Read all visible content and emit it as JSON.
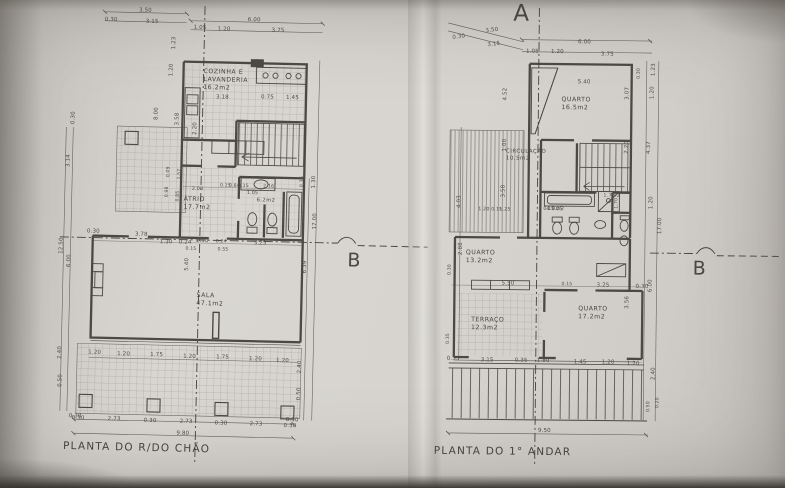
{
  "photo": {
    "paper_color": "#d7d4cf",
    "line_color": "#4c4944",
    "text_color": "#504d48"
  },
  "left_plan": {
    "title": "PLANTA DO R/DO CHÃO",
    "section_b": "B",
    "labels": [
      {
        "n": "room-label-cozinha",
        "c": "room",
        "t": "COZINHA E\nLAVANDERIA\n16.2m2",
        "x": 200,
        "y": 68
      },
      {
        "n": "room-label-atrio",
        "c": "room",
        "t": "ÁTRIO\n17.7m2",
        "x": 183,
        "y": 196
      },
      {
        "n": "room-label-is",
        "c": "room",
        "t": "6.2m2",
        "x": 256,
        "y": 196,
        "s": 5
      },
      {
        "n": "room-label-sala",
        "c": "room",
        "t": "SALA\n47.1m2",
        "x": 198,
        "y": 292
      },
      {
        "t": "3.50",
        "x": 134,
        "y": 9
      },
      {
        "t": "0.30",
        "x": 100,
        "y": 19
      },
      {
        "t": "3.15",
        "x": 141,
        "y": 20
      },
      {
        "t": "6.00",
        "x": 243,
        "y": 16
      },
      {
        "t": "1.05",
        "x": 189,
        "y": 25
      },
      {
        "t": "1.20",
        "x": 213,
        "y": 26
      },
      {
        "t": "3.75",
        "x": 267,
        "y": 26
      },
      {
        "t": "0.30",
        "x": 68,
        "y": 127,
        "r": -90
      },
      {
        "t": "3.14",
        "x": 64,
        "y": 170,
        "r": -90
      },
      {
        "t": "1.23",
        "x": 167,
        "y": 50,
        "r": -90
      },
      {
        "t": "1.20",
        "x": 165,
        "y": 77,
        "r": -90
      },
      {
        "t": "8.00",
        "x": 151,
        "y": 121,
        "r": -90
      },
      {
        "t": "3.58",
        "x": 172,
        "y": 126,
        "r": -90
      },
      {
        "t": "2.20",
        "x": 190,
        "y": 135,
        "r": -90
      },
      {
        "t": "3.18",
        "x": 213,
        "y": 94
      },
      {
        "t": "0.75",
        "x": 258,
        "y": 93
      },
      {
        "t": "1.45",
        "x": 283,
        "y": 93
      },
      {
        "t": "0.09",
        "x": 165,
        "y": 178,
        "r": -90,
        "s": 4.6
      },
      {
        "t": "1.57",
        "x": 176,
        "y": 180,
        "r": -90,
        "s": 4.6
      },
      {
        "t": "0.98",
        "x": 164,
        "y": 198,
        "r": -90,
        "s": 4.6
      },
      {
        "t": "0.85",
        "x": 175,
        "y": 202,
        "r": -90,
        "s": 4.6
      },
      {
        "t": "2.00",
        "x": 191,
        "y": 187,
        "s": 4.8
      },
      {
        "t": "0.15",
        "x": 219,
        "y": 183,
        "s": 4.6
      },
      {
        "t": "0.84",
        "x": 228,
        "y": 183,
        "s": 4.6
      },
      {
        "t": "0.15",
        "x": 237,
        "y": 183,
        "s": 4.6
      },
      {
        "t": "2.16",
        "x": 262,
        "y": 183,
        "s": 4.8
      },
      {
        "t": "1.05",
        "x": 246,
        "y": 190,
        "s": 4.8
      },
      {
        "t": "0.36",
        "x": 299,
        "y": 185,
        "r": -90,
        "s": 4.8
      },
      {
        "t": "1.30",
        "x": 310,
        "y": 186,
        "r": -90
      },
      {
        "t": "17.00",
        "x": 312,
        "y": 227,
        "r": -90
      },
      {
        "t": "12.50",
        "x": 59,
        "y": 257,
        "r": -90
      },
      {
        "t": "6.00",
        "x": 67,
        "y": 270,
        "r": -90
      },
      {
        "t": "2.40",
        "x": 60,
        "y": 362,
        "r": -90
      },
      {
        "t": "0.50",
        "x": 61,
        "y": 390,
        "r": -90
      },
      {
        "t": "0.30",
        "x": 73,
        "y": 416
      },
      {
        "t": "0.30",
        "x": 87,
        "y": 231
      },
      {
        "t": "3.78",
        "x": 135,
        "y": 233
      },
      {
        "t": "1.30",
        "x": 160,
        "y": 240
      },
      {
        "t": "0.24",
        "x": 179,
        "y": 240
      },
      {
        "t": "0.15",
        "x": 186,
        "y": 247,
        "s": 4.6
      },
      {
        "t": "1.90",
        "x": 196,
        "y": 238
      },
      {
        "t": "0.24",
        "x": 216,
        "y": 239,
        "s": 4.6
      },
      {
        "t": "0.55",
        "x": 218,
        "y": 247,
        "s": 4.6
      },
      {
        "t": "3.25",
        "x": 254,
        "y": 239
      },
      {
        "t": "5.40",
        "x": 185,
        "y": 271,
        "r": -90
      },
      {
        "t": "6.39",
        "x": 303,
        "y": 271,
        "r": -90
      },
      {
        "t": "2.40",
        "x": 300,
        "y": 371,
        "r": -90
      },
      {
        "t": "0.50",
        "x": 300,
        "y": 398,
        "r": -90
      },
      {
        "t": "0.30",
        "x": 290,
        "y": 415
      },
      {
        "t": "1.20",
        "x": 91,
        "y": 352
      },
      {
        "t": "1.20",
        "x": 120,
        "y": 353
      },
      {
        "t": "1.75",
        "x": 153,
        "y": 353
      },
      {
        "t": "1.20",
        "x": 186,
        "y": 354
      },
      {
        "t": "1.75",
        "x": 219,
        "y": 354
      },
      {
        "t": "1.20",
        "x": 252,
        "y": 355
      },
      {
        "t": "1.20",
        "x": 279,
        "y": 356
      },
      {
        "t": "0.30",
        "x": 76,
        "y": 418
      },
      {
        "t": "2.73",
        "x": 112,
        "y": 418
      },
      {
        "t": "0.30",
        "x": 148,
        "y": 419
      },
      {
        "t": "2.73",
        "x": 184,
        "y": 419
      },
      {
        "t": "0.30",
        "x": 219,
        "y": 420
      },
      {
        "t": "2.73",
        "x": 254,
        "y": 420
      },
      {
        "t": "0.30",
        "x": 288,
        "y": 421
      },
      {
        "t": "9.80",
        "x": 181,
        "y": 431
      }
    ]
  },
  "right_plan": {
    "title": "PLANTA DO 1° ANDAR",
    "section_a": "A",
    "section_b": "B",
    "labels": [
      {
        "n": "room-label-quarto-165",
        "c": "room",
        "t": "QUARTO\n16.5m2",
        "x": 560,
        "y": 96
      },
      {
        "n": "room-label-circulacao",
        "c": "room",
        "t": "CIRCULAÇÃO\n10.5m2",
        "x": 505,
        "y": 149,
        "s": 5.4
      },
      {
        "n": "room-label-is-40",
        "c": "room",
        "t": "4.0m2",
        "x": 546,
        "y": 207,
        "s": 4.8
      },
      {
        "n": "room-label-is-17",
        "c": "room",
        "t": "1.7m2",
        "x": 603,
        "y": 193,
        "s": 4.4
      },
      {
        "n": "room-label-quarto-132",
        "c": "room",
        "t": "QUARTO\n13.2m2",
        "x": 466,
        "y": 250
      },
      {
        "n": "room-label-terraco",
        "c": "room",
        "t": "TERRAÇO\n12.3m2",
        "x": 472,
        "y": 317
      },
      {
        "n": "room-label-quarto-172",
        "c": "room",
        "t": "QUARTO\n17.2m2",
        "x": 579,
        "y": 305
      },
      {
        "t": "3.50",
        "x": 483,
        "y": 29,
        "r": -8
      },
      {
        "t": "0.30",
        "x": 450,
        "y": 36,
        "r": -8
      },
      {
        "t": "3.15",
        "x": 485,
        "y": 43,
        "r": -8
      },
      {
        "t": "6.00",
        "x": 576,
        "y": 39
      },
      {
        "t": "1.05",
        "x": 524,
        "y": 49
      },
      {
        "t": "1.20",
        "x": 549,
        "y": 49
      },
      {
        "t": "3.75",
        "x": 599,
        "y": 51
      },
      {
        "t": "5.40",
        "x": 576,
        "y": 79
      },
      {
        "t": "4.52",
        "x": 501,
        "y": 101,
        "r": -90
      },
      {
        "t": "1.00",
        "x": 501,
        "y": 152,
        "r": -90
      },
      {
        "t": "3.58",
        "x": 500,
        "y": 198,
        "r": -90
      },
      {
        "t": "1.23",
        "x": 649,
        "y": 75,
        "r": -90
      },
      {
        "t": "0.30",
        "x": 635,
        "y": 78,
        "r": -90,
        "s": 4.6
      },
      {
        "t": "3.07",
        "x": 623,
        "y": 99,
        "r": -90
      },
      {
        "t": "1.20",
        "x": 648,
        "y": 98,
        "r": -90
      },
      {
        "t": "2.20",
        "x": 623,
        "y": 153,
        "r": -90
      },
      {
        "t": "4.37",
        "x": 645,
        "y": 153,
        "r": -90
      },
      {
        "t": "1.70",
        "x": 614,
        "y": 208,
        "r": -90,
        "s": 4.6
      },
      {
        "t": "1.20",
        "x": 648,
        "y": 208,
        "r": -90
      },
      {
        "t": "17.00",
        "x": 657,
        "y": 233,
        "r": -90
      },
      {
        "t": "4.03",
        "x": 456,
        "y": 209,
        "r": -90
      },
      {
        "t": "2.88",
        "x": 458,
        "y": 256,
        "r": -90
      },
      {
        "t": "0.30",
        "x": 448,
        "y": 276,
        "r": -90,
        "s": 4.6
      },
      {
        "t": "1.20",
        "x": 478,
        "y": 208,
        "s": 4.8
      },
      {
        "t": "0.15",
        "x": 491,
        "y": 208,
        "s": 4.6
      },
      {
        "t": "1.25",
        "x": 499,
        "y": 208,
        "s": 4.8
      },
      {
        "t": "0.15",
        "x": 543,
        "y": 207,
        "s": 4.6
      },
      {
        "t": "1.25",
        "x": 551,
        "y": 207,
        "s": 4.8
      },
      {
        "t": "5.50",
        "x": 502,
        "y": 281
      },
      {
        "t": "0.15",
        "x": 562,
        "y": 282,
        "s": 4.6
      },
      {
        "t": "3.25",
        "x": 597,
        "y": 282
      },
      {
        "t": "0.30",
        "x": 636,
        "y": 283
      },
      {
        "t": "6.00",
        "x": 648,
        "y": 291,
        "r": -90
      },
      {
        "t": "3.56",
        "x": 625,
        "y": 308,
        "r": -90
      },
      {
        "t": "0.35",
        "x": 447,
        "y": 345,
        "r": -90,
        "s": 4.6
      },
      {
        "t": "0.35",
        "x": 448,
        "y": 357
      },
      {
        "t": "3.15",
        "x": 482,
        "y": 358
      },
      {
        "t": "0.35",
        "x": 516,
        "y": 358
      },
      {
        "t": "1.80",
        "x": 538,
        "y": 358
      },
      {
        "t": "1.45",
        "x": 575,
        "y": 359
      },
      {
        "t": "1.20",
        "x": 603,
        "y": 359
      },
      {
        "t": "1.20",
        "x": 628,
        "y": 360
      },
      {
        "t": "2.40",
        "x": 652,
        "y": 379,
        "r": -90
      },
      {
        "t": "0.50",
        "x": 648,
        "y": 411,
        "r": -90,
        "s": 4.6
      },
      {
        "t": "0.20",
        "x": 657,
        "y": 407,
        "r": -90,
        "s": 4.6
      },
      {
        "t": "9.50",
        "x": 540,
        "y": 428
      }
    ]
  }
}
